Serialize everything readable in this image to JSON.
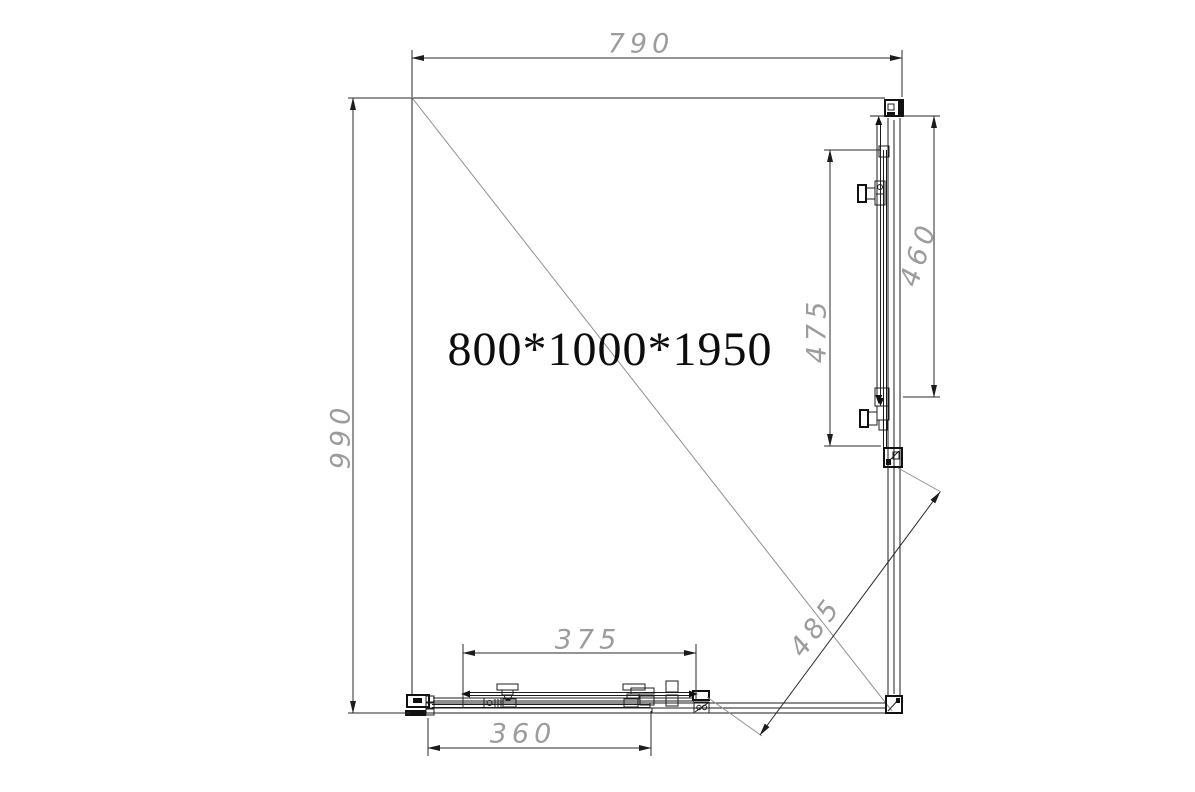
{
  "drawing": {
    "product_size": "800*1000*1950",
    "dims": {
      "width_mm": "790",
      "depth_mm": "990",
      "bottom_rail_mm": "375",
      "bottom_fixed_panel_mm": "360",
      "side_door_glass_mm": "475",
      "side_rail_mm": "460",
      "diagonal_opening_mm": "485"
    },
    "colors": {
      "line": "#1c1c1c",
      "dimension_text": "#9c9c9c",
      "diagonal_line": "#8f8f8f",
      "background": "#ffffff"
    }
  }
}
